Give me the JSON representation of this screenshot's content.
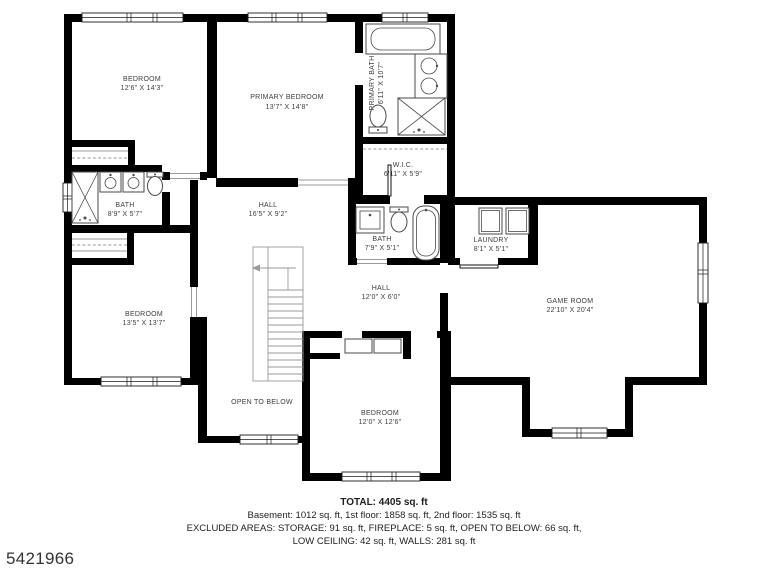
{
  "plan": {
    "colors": {
      "wall": "#000000",
      "label": "#3d3d3d",
      "fixture_line": "#4a4a4a"
    },
    "rooms": {
      "bedroom1": {
        "name": "BEDROOM",
        "dims": "12'6\" X 14'3\""
      },
      "primary_bedroom": {
        "name": "PRIMARY BEDROOM",
        "dims": "13'7\" X 14'8\""
      },
      "primary_bath": {
        "name": "PRIMARY BATH",
        "dims": "6'11\" X 10'7\""
      },
      "wic": {
        "name": "W.I.C.",
        "dims": "6'11\" X 5'9\""
      },
      "bath1": {
        "name": "BATH",
        "dims": "8'9\" X 5'7\""
      },
      "hall1": {
        "name": "HALL",
        "dims": "16'5\" X 9'2\""
      },
      "bath2": {
        "name": "BATH",
        "dims": "7'9\" X 5'1\""
      },
      "laundry": {
        "name": "LAUNDRY",
        "dims": "8'1\" X 5'1\""
      },
      "game_room": {
        "name": "GAME ROOM",
        "dims": "22'10\" X 20'4\""
      },
      "bedroom2": {
        "name": "BEDROOM",
        "dims": "13'5\" X 13'7\""
      },
      "hall2": {
        "name": "HALL",
        "dims": "12'0\" X 6'0\""
      },
      "open_to_below": {
        "name": "OPEN TO BELOW"
      },
      "bedroom3": {
        "name": "BEDROOM",
        "dims": "12'0\" X 12'6\""
      }
    }
  },
  "footer": {
    "total": "TOTAL: 4405 sq. ft",
    "line1": "Basement: 1012 sq. ft, 1st floor: 1858 sq. ft, 2nd floor: 1535 sq. ft",
    "line2": "EXCLUDED AREAS: STORAGE: 91 sq. ft, FIREPLACE: 5 sq. ft, OPEN TO BELOW: 66 sq. ft,",
    "line3": "LOW CEILING: 42 sq. ft, WALLS: 281 sq. ft"
  },
  "photo_id": "5421966"
}
